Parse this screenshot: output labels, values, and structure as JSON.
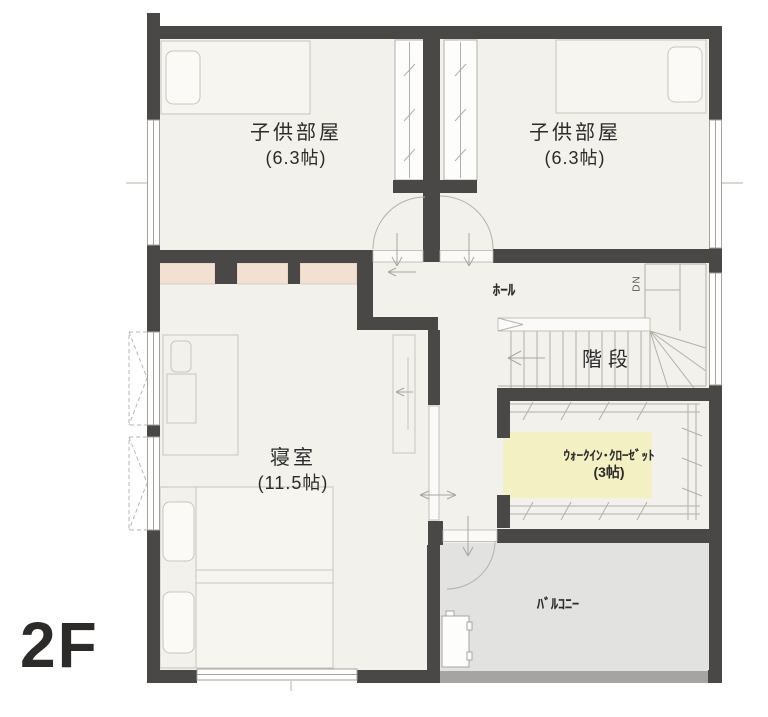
{
  "floor_label": "2F",
  "rooms": {
    "child_room_1": {
      "name": "子供部屋",
      "size": "(6.3帖)"
    },
    "child_room_2": {
      "name": "子供部屋",
      "size": "(6.3帖)"
    },
    "bedroom": {
      "name": "寝室",
      "size": "(11.5帖)"
    },
    "hall": {
      "name": "ﾎｰﾙ"
    },
    "stairs": {
      "name": "階段",
      "direction_label": "DN"
    },
    "walk_in_closet": {
      "name": "ｳｫｰｸｲﾝ･ｸﾛｰｾﾞｯﾄ",
      "size": "(3帖)"
    },
    "balcony": {
      "name": "ﾊﾞﾙｺﾆｰ"
    }
  },
  "colors": {
    "wall": "#4a4846",
    "floor": "#f2f1ec",
    "balcony_floor": "#e2e2e1",
    "balcony_rail": "#a5a4a3",
    "closet_pink": "#f2e0d1",
    "wic_highlight": "#f3f0c3",
    "text": "#2b2b2b"
  }
}
